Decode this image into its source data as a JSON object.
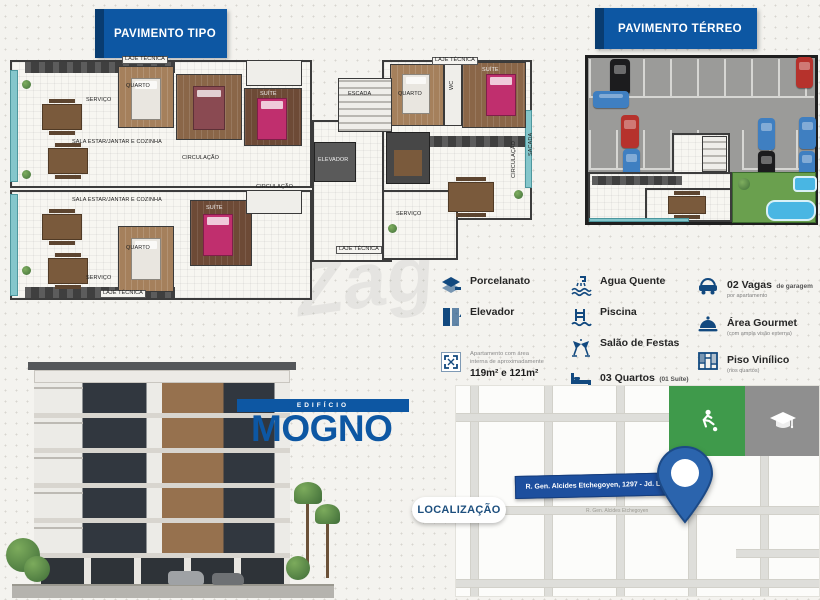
{
  "poster": {
    "watermark": "Zag"
  },
  "headers": {
    "tipo": "PAVIMENTO TIPO",
    "terreo": "PAVIMENTO TÉRREO"
  },
  "plan_labels": {
    "laje_tecnica": "LAJE TÉCNICA",
    "quarto": "QUARTO",
    "suite": "SUÍTE",
    "servico": "SERVIÇO",
    "sala": "SALA ESTAR/JANTAR E COZINHA",
    "circulacao": "CIRCULAÇÃO",
    "elevador": "ELEVADOR",
    "escada": "ESCADA",
    "sacada": "SACADA",
    "wc": "WC"
  },
  "amenities": {
    "col1": [
      {
        "icon": "tiles-icon",
        "label": "Porcelanato"
      },
      {
        "icon": "elevator-icon",
        "label": "Elevador"
      },
      {
        "icon": "expand-icon",
        "note_line1": "Apartamento com área",
        "note_line2": "interna de aproximadamente",
        "value": "119m² e 121m²"
      }
    ],
    "col2": [
      {
        "icon": "hot-water-icon",
        "label": "Agua Quente"
      },
      {
        "icon": "pool-ladder-icon",
        "label": "Piscina"
      },
      {
        "icon": "party-icon",
        "label": "Salão de Festas"
      },
      {
        "icon": "bed-icon",
        "label": "03 Quartos",
        "sub": "(01 Suíte)"
      }
    ],
    "col3": [
      {
        "icon": "car-icon",
        "label": "02 Vagas",
        "sub_inline": "de garagem",
        "sub": "por apartamento"
      },
      {
        "icon": "cloche-icon",
        "label": "Área Gourmet",
        "sub": "(com ampla visão externa)"
      },
      {
        "icon": "plank-icon",
        "label": "Piso Vinílico",
        "sub": "(nos quartos)"
      }
    ]
  },
  "logo": {
    "prefix": "EDIFÍCIO",
    "name": "MOGNO"
  },
  "map": {
    "pill": "LOCALIZAÇÃO",
    "address": "R. Gen. Alcides Etchegoyen, 1297 - Jd. La Salle",
    "street": "R. Gen. Alcides Etchegoyen"
  }
}
